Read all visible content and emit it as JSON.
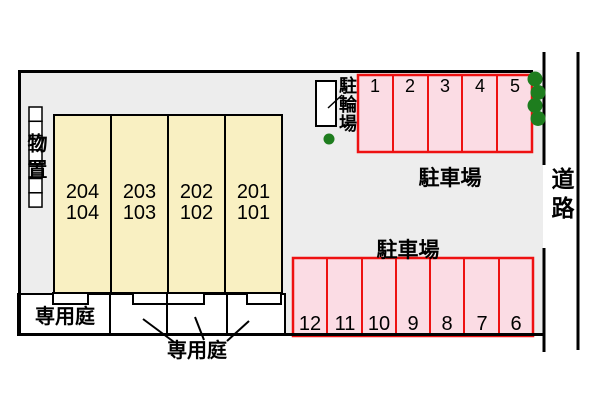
{
  "building": {
    "units": [
      {
        "upper": "204",
        "lower": "104"
      },
      {
        "upper": "203",
        "lower": "103"
      },
      {
        "upper": "202",
        "lower": "102"
      },
      {
        "upper": "201",
        "lower": "101"
      }
    ]
  },
  "storage": {
    "label": "物置"
  },
  "bicycle_parking": {
    "label": "駐輪場"
  },
  "parking_top": {
    "label": "駐車場",
    "spaces": [
      "1",
      "2",
      "3",
      "4",
      "5"
    ]
  },
  "parking_bottom": {
    "label": "駐車場",
    "spaces": [
      "12",
      "11",
      "10",
      "9",
      "8",
      "7",
      "6"
    ]
  },
  "garden": {
    "label_inline": "専用庭",
    "label_below": "専用庭"
  },
  "road": {
    "label": "道路"
  },
  "colors": {
    "plot_bg": "#ededed",
    "building_fill": "#f9f0c2",
    "parking_fill": "#fbdce4",
    "parking_border": "#ee1111",
    "tree_green": "#1e7d1e",
    "line_black": "#000000"
  }
}
